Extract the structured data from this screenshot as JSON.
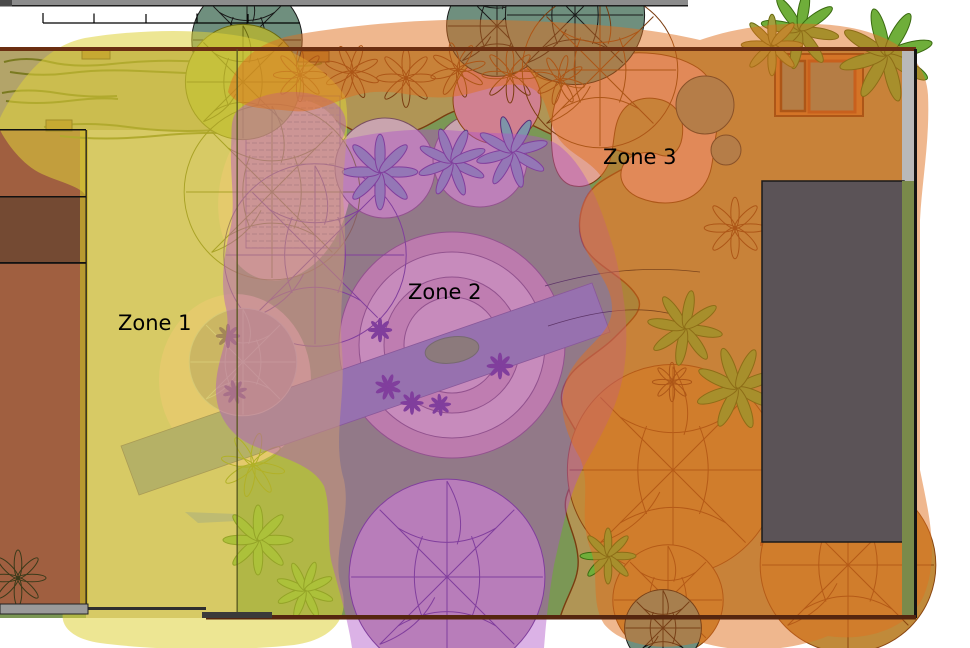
{
  "zones": [
    {
      "id": "zone-1",
      "label": "Zone 1",
      "overlay_color": "#ded23a"
    },
    {
      "id": "zone-2",
      "label": "Zone 2",
      "overlay_color": "#b054c8"
    },
    {
      "id": "zone-3",
      "label": "Zone 3",
      "overlay_color": "#e0701e"
    }
  ],
  "palette": {
    "lawn": "#7b9755",
    "bed": "#b09555",
    "bed-line": "#7a3c10",
    "topleft": "#b3a469",
    "patio": "#cfc29a",
    "house": "#a05f40",
    "house-dark": "#744a33",
    "house-strip": "#b89a30",
    "pink": "#e2a292",
    "pink-soft": "#ecc0a8",
    "ring-outer": "#c79b98",
    "ring-mid": "#dbb8b2",
    "ring-inner": "#cc9e9e",
    "red-bed": "#d08090",
    "walk": "#83899b",
    "shed": "#5b5357",
    "strip-green": "#7a8a4a",
    "corner-gray": "#b9b9b9",
    "boulder": "#8a8a72",
    "bin": "#8b8b6d",
    "bin-frame": "#c87831",
    "tree-teal": "#6f8f7e",
    "tree-olive": "#a9ad3e",
    "tree-orange": "#c08a3a",
    "tree-pink": "#bf9fb0",
    "plant-green": "#6fae3a",
    "plant-gray": "#7e94a8",
    "purple": "#5b2d7a",
    "zone1": "#ded23a",
    "zone2": "#b054c8",
    "zone3": "#e0701e",
    "fence": "#6b2f12"
  }
}
